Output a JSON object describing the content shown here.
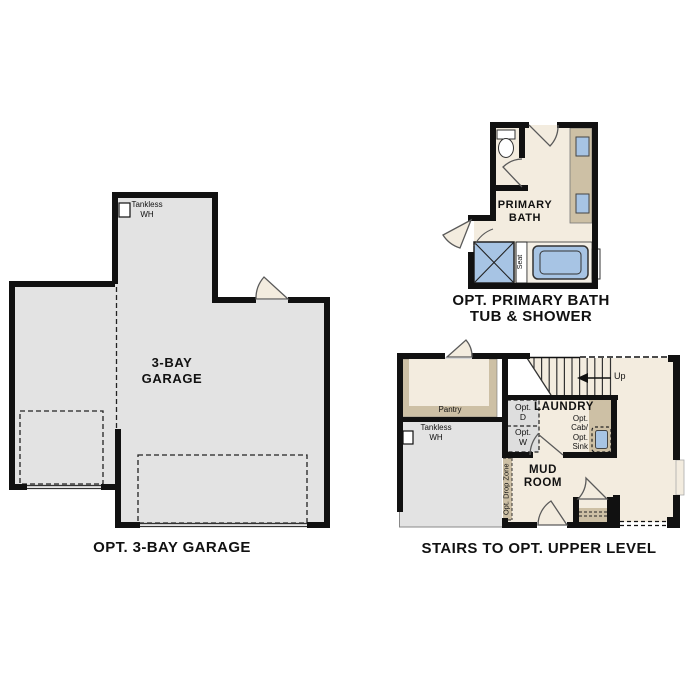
{
  "colors": {
    "background": "#ffffff",
    "wall_black": "#111111",
    "floor_cream": "#f3ecdf",
    "floor_gray": "#e3e3e3",
    "cabinet_tan": "#cdc0a5",
    "fixture_blue": "#a7c4e4",
    "door_swing_gray": "#5a5a5a"
  },
  "plans": {
    "garage": {
      "caption": "OPT. 3-BAY GARAGE",
      "room_label": {
        "line1": "3-BAY",
        "line2": "GARAGE"
      },
      "tankless": {
        "line1": "Tankless",
        "line2": "WH"
      }
    },
    "primary_bath": {
      "caption": {
        "line1": "OPT. PRIMARY BATH",
        "line2": "TUB & SHOWER"
      },
      "room_label": {
        "line1": "PRIMARY",
        "line2": "BATH"
      },
      "seat_label": "Seat"
    },
    "stairs_level": {
      "caption": "STAIRS TO OPT. UPPER LEVEL",
      "up_label": "Up",
      "pantry_label": "Pantry",
      "tankless": {
        "line1": "Tankless",
        "line2": "WH"
      },
      "laundry_label": "LAUNDRY",
      "opt_dryer": {
        "line1": "Opt.",
        "line2": "D"
      },
      "opt_washer": {
        "line1": "Opt.",
        "line2": "W"
      },
      "opt_cab_sink": {
        "line1": "Opt.",
        "line2": "Cab/",
        "line3": "Opt.",
        "line4": "Sink"
      },
      "mud_room": {
        "line1": "MUD",
        "line2": "ROOM"
      },
      "drop_zone_label": "Opt. Drop Zone"
    }
  }
}
